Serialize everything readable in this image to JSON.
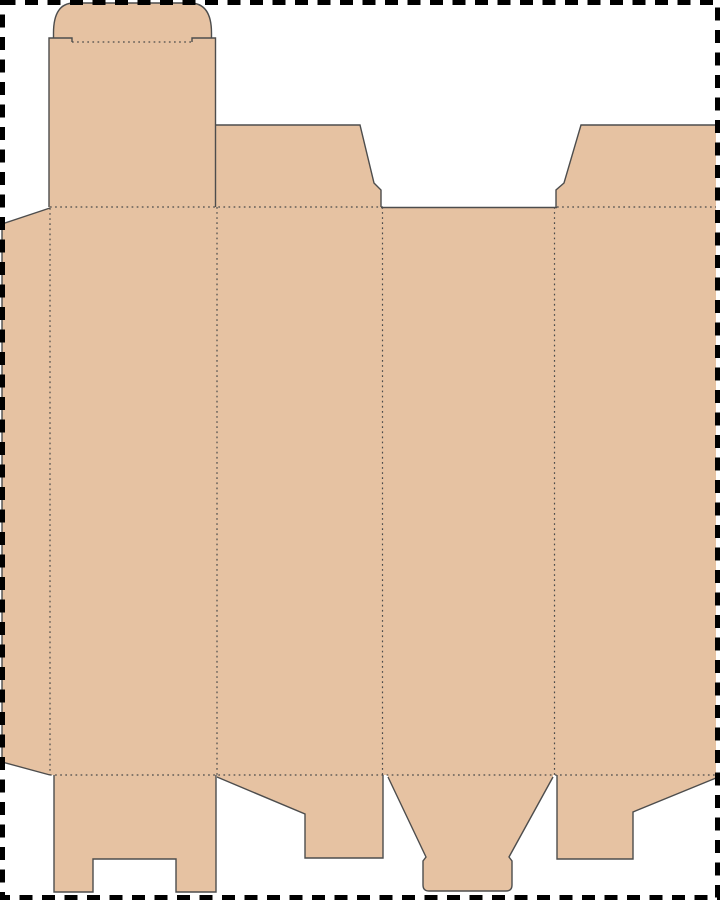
{
  "document": {
    "kind": "packaging-dieline-template",
    "description": "Die-cut layout drawing of a folding tuck-top carton: glue flap, four body panels, rounded tuck-lid flap, two top dust flaps, and four bottom closure flaps, surrounded by a dashed trim border."
  },
  "canvas": {
    "width": 720,
    "height": 900,
    "background": "#ffffff"
  },
  "colors": {
    "board_fill": "#e6c2a2",
    "cut_line": "#4d4d4d",
    "fold_line": "#4a4a4a",
    "trim_border": "#000000"
  },
  "styles": {
    "cut_width": 1.4,
    "fold_width": 1.2,
    "fold_dash": "1.7 3.4",
    "border_width": 5,
    "border_dash": "13 9.5",
    "border_inset": 2.5
  },
  "fill_shapes": [
    {
      "name": "glue-flap",
      "path": "M2,224 L50,208 L50,775 L2,762 Z"
    },
    {
      "name": "tuck-lid-flap",
      "path": "M49,207 L49,38 L53.5,38 L53.5,33 Q53.5,3 74,3 L190,3 Q211.5,3 211.5,33 L211.5,38 L215.5,38 L215.5,207 Z"
    },
    {
      "name": "main-body-panels",
      "path": "M49,207 L716,207 L716,775 L49,775 Z"
    },
    {
      "name": "top-dust-flap-left",
      "path": "M215.5,207 L215.5,125 L360,125 L374,183 L381,190 L381,207 Z"
    },
    {
      "name": "top-dust-flap-right",
      "path": "M556,207 L556,190 L564,183 L581,125 L716,125 L716,207 Z"
    },
    {
      "name": "bottom-flap-panel1",
      "path": "M54,775 L54,892 L93,892 L93,859 L176,859 L176,892 L216,892 L216,775 Z"
    },
    {
      "name": "bottom-flap-panel2",
      "path": "M217,775 L217,777 L305,814 L305,858 L383,858 L383,775 Z"
    },
    {
      "name": "bottom-flap-panel3",
      "path": "M388,775 L388,777 L426,857 L423,861 L423,885 Q423,891 429,891 L506,891 Q512,891 512,885 L512,861 L509,857 L553,777 L553,775 Z"
    },
    {
      "name": "bottom-flap-panel4",
      "path": "M557,775 L557,859 L633,859 L633,812 L716,778 L716,775 Z"
    }
  ],
  "cut_lines": [
    {
      "name": "glue-flap-cut",
      "path": "M50,208 L2,224 L2,762 L50,775"
    },
    {
      "name": "tuck-panel-left-cut",
      "path": "M49,207 L49,38 L72,38 L72,42"
    },
    {
      "name": "tuck-panel-right-cut",
      "path": "M192,42 L192,38 L215.5,38 L215.5,207"
    },
    {
      "name": "tuck-dome-cut",
      "path": "M53.5,38 L53.5,33 Q53.5,3 74,3 L190,3 Q211.5,3 211.5,33 L211.5,38"
    },
    {
      "name": "top-dust-flap-left-cut",
      "path": "M215.5,125 L360,125 L374,183 L381,190 L381,207"
    },
    {
      "name": "panel3-top-edge-cut",
      "path": "M381,207.5 L557,207.5"
    },
    {
      "name": "top-dust-flap-right-cut",
      "path": "M556,207 L556,190 L564,183 L581,125 L716,125"
    },
    {
      "name": "bottom-flap1-cut",
      "path": "M54,775 L54,892 L93,892 L93,859 L176,859 L176,892 L216,892 L216,775"
    },
    {
      "name": "bottom-flap2-cut",
      "path": "M217,777 L305,814 L305,858 L383,858 L383,775"
    },
    {
      "name": "bottom-flap3-cut",
      "path": "M388,777 L426,857 L423,861 L423,885 Q423,891 429,891 L506,891 Q512,891 512,885 L512,861 L509,857 L553,777"
    },
    {
      "name": "bottom-flap4-cut",
      "path": "M557,775 L557,859 L633,859 L633,812 L716,778"
    }
  ],
  "fold_lines": [
    {
      "name": "top-fold-left-segment",
      "path": "M50,207 L383,207"
    },
    {
      "name": "top-fold-right-segment",
      "path": "M557,207 L716,207"
    },
    {
      "name": "bottom-fold",
      "path": "M50,775 L716,775"
    },
    {
      "name": "glue-flap-fold",
      "path": "M50,208 L50,775"
    },
    {
      "name": "panel1-panel2-fold",
      "path": "M217,207 L217,775"
    },
    {
      "name": "panel2-panel3-fold",
      "path": "M382.5,207 L382.5,775"
    },
    {
      "name": "panel3-panel4-fold",
      "path": "M554.5,207 L554.5,775"
    },
    {
      "name": "tuck-slit-fold",
      "path": "M72,42 L192,42"
    }
  ]
}
